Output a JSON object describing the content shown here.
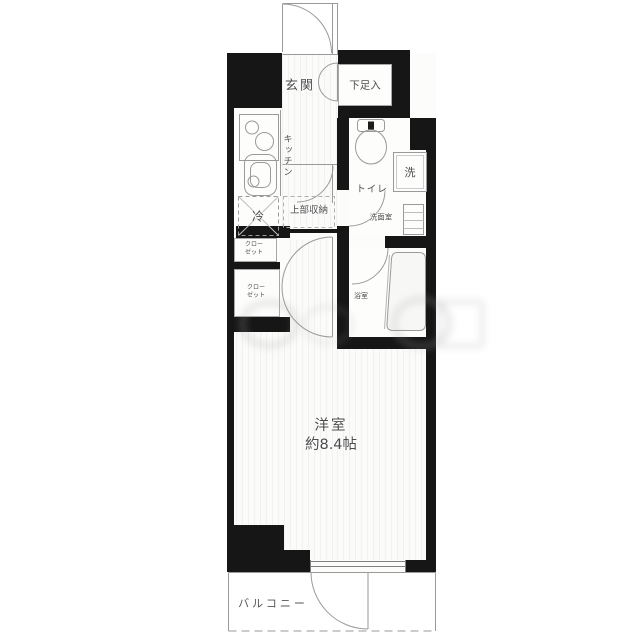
{
  "floorplan": {
    "rooms": {
      "genkan": {
        "label": "玄関"
      },
      "shoe_storage": {
        "label": "下足入"
      },
      "kitchen": {
        "label": "キッチン"
      },
      "fridge": {
        "label": "冷"
      },
      "upper_storage": {
        "label": "上部収納"
      },
      "toilet": {
        "label": "トイレ"
      },
      "washer": {
        "label": "洗"
      },
      "washroom": {
        "label": "洗面室"
      },
      "closet_upper": {
        "line1": "クロー",
        "line2": "ゼット"
      },
      "closet_lower": {
        "line1": "クロー",
        "line2": "ゼット"
      },
      "bathroom": {
        "label": "浴室"
      },
      "main_room": {
        "name": "洋室",
        "size": "約8.4帖"
      },
      "balcony": {
        "label": "バルコニー"
      }
    },
    "colors": {
      "wall": "#161616",
      "fixture_line": "#9a9a9a",
      "label_text": "#4d4d4d",
      "floor": "#fbfbfa"
    }
  }
}
